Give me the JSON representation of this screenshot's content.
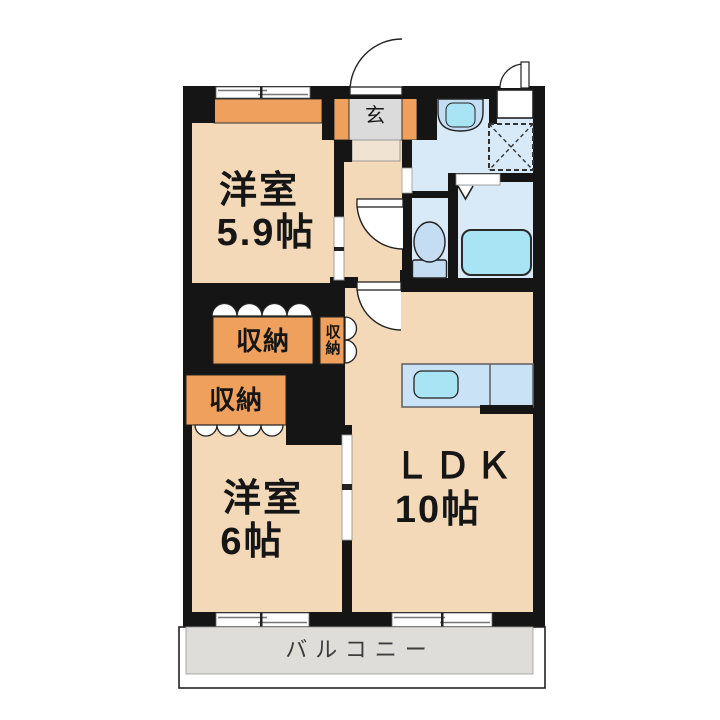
{
  "labels": {
    "room59_name": "洋室",
    "room59_size": "5.9帖",
    "room6_name": "洋室",
    "room6_size": "6帖",
    "ldk_name": "ＬＤＫ",
    "ldk_size": "10帖",
    "entrance": "玄",
    "balcony": "バルコニー",
    "storage_upper": "収納",
    "storage_side": "収納",
    "storage_lower": "収納"
  },
  "colors": {
    "wall": "#151515",
    "room_floor": "#F3D9B8",
    "storage_fill": "#EFA05C",
    "wet_floor": "#D8EAF8",
    "fixture_blue": "#C5DDF3",
    "water_cyan": "#A9E4F4",
    "counter_blue": "#C9E2F5",
    "entrance_gray": "#DBDBDB",
    "step_tan": "#F0E3D1",
    "balcony_gray": "#DFDDD9",
    "door_white": "#FFFFFF"
  },
  "fixtures": [
    "entrance-door",
    "vanity-basin",
    "washing-machine-space",
    "bathtub",
    "toilet",
    "kitchen-counter",
    "kitchen-sink",
    "folding-closet-doors",
    "sliding-windows",
    "balcony"
  ]
}
